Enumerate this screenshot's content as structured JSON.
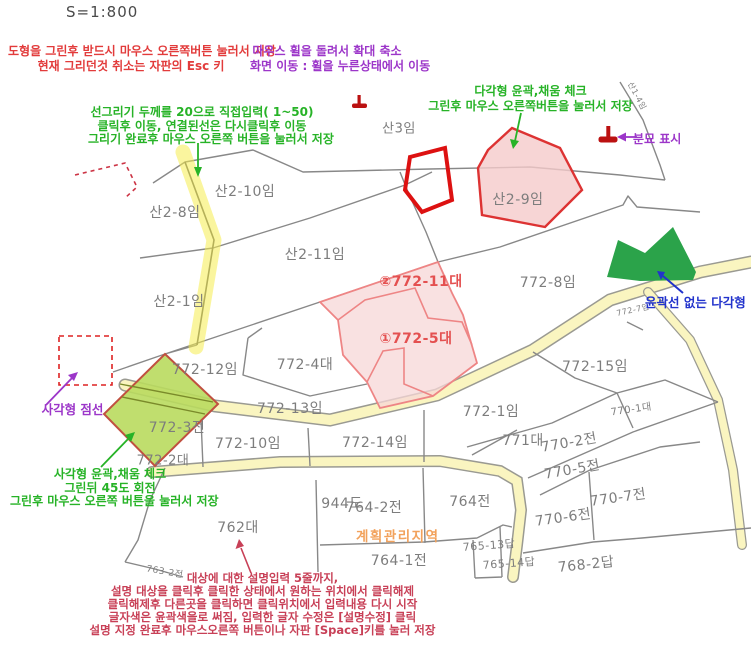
{
  "colors": {
    "red_instruction": "#e23b3b",
    "purple_instruction": "#9c36c9",
    "green_instruction": "#27b327",
    "blue_label": "#2233cc",
    "crimson_description": "#c84057",
    "zone_orange": "#f2a25c",
    "parcel_gray": "#7d7d7d",
    "parcel_red": "#e45050",
    "road_yellow": "#faf5c0",
    "road_edge": "#9a9a92",
    "highlight_yellow": "#f5ec4e",
    "pink_fill": "#f7d7d7",
    "pink_stroke": "#ee8585",
    "red_shape": "#dd1111",
    "pentagon_fill": "#f5caca",
    "pentagon_stroke": "#dd3333",
    "green_fill": "#2ba34a",
    "diamond_fill": "#b9da5e",
    "diamond_stroke": "#c05040",
    "boundary_gray": "#888888",
    "grave_red": "#bb1111"
  },
  "scale_label": "S=1:800",
  "annotations": {
    "draw_save_red": {
      "line1": "도형을 그린후 받드시 마우스 오른쪽버튼 눌러서 저장",
      "line2": "현재 그리던것 취소는 자판의 Esc 키"
    },
    "mouse_wheel_purple": {
      "line1": "마우스 휠을 돌려서 확대 축소",
      "line2": "화면 이동 : 휠을 누른상태에서 이동"
    },
    "line_draw_green": {
      "line1": "선그리기 두께를 20으로 직접입력( 1~50)",
      "line2": "클릭후 이동, 연결된선은 다시클릭후 이동",
      "line3": "그리기 완료후 마우스 오른쪽 버튼을 눌러서 저장"
    },
    "polygon_green": {
      "line1": "다각형 윤곽,채움 체크",
      "line2": "그린후 마우스 오른쪽버튼을 눌러서 저장"
    },
    "grave_purple": {
      "label": "분묘 표시"
    },
    "dashed_purple": {
      "label": "사각형 점선"
    },
    "rect_green": {
      "line1": "사각형 윤곽,채움 체크",
      "line2": "그린뒤 45도 회전",
      "line3": "그린후 마우스 오른쪽 버튼을 눌러서 저장"
    },
    "no_outline_blue": {
      "label": "윤곽선 없는 다각형"
    },
    "zone_orange": {
      "label": "계획관리지역"
    },
    "description_crimson": {
      "line1": "대상에 대한 설명입력 5줄까지,",
      "line2": "설명 대상을 클릭후 클릭한 상태에서 원하는 위치에서 클릭해제",
      "line3": "클릭해제후 다른곳을 클릭하면 클릭위치에서 입력내용 다시 시작",
      "line4": "글자색은 윤곽색을로 써짐, 입력한 글자 수정은 [설명수정] 클릭",
      "line5": "설명 지정 완료후 마우스오른쪽 버튼이나 자판 [Space]키를 눌러 저장"
    }
  },
  "map": {
    "parcels": [
      {
        "t": "산3임",
        "x": 399,
        "y": 127,
        "fs": 13
      },
      {
        "t": "산2-10임",
        "x": 245,
        "y": 191,
        "fs": 14
      },
      {
        "t": "산2-8임",
        "x": 175,
        "y": 212,
        "fs": 14
      },
      {
        "t": "산2-11임",
        "x": 315,
        "y": 254,
        "fs": 14
      },
      {
        "t": "산2-1임",
        "x": 179,
        "y": 301,
        "fs": 14
      },
      {
        "t": "산2-9임",
        "x": 518,
        "y": 199,
        "fs": 14
      },
      {
        "t": "산1-4임",
        "x": 637,
        "y": 96,
        "fs": 8,
        "rot": 62
      },
      {
        "t": "772-8임",
        "x": 548,
        "y": 282,
        "fs": 14
      },
      {
        "t": "772-7임",
        "x": 633,
        "y": 310,
        "fs": 8,
        "rot": -12
      },
      {
        "t": "②772-11대",
        "x": 421,
        "y": 281,
        "fs": 14,
        "c": "red"
      },
      {
        "t": "①772-5대",
        "x": 416,
        "y": 338,
        "fs": 14,
        "c": "red"
      },
      {
        "t": "772-4대",
        "x": 305,
        "y": 364,
        "fs": 14
      },
      {
        "t": "772-12임",
        "x": 205,
        "y": 369,
        "fs": 14
      },
      {
        "t": "772-13임",
        "x": 290,
        "y": 408,
        "fs": 14
      },
      {
        "t": "772-3전",
        "x": 177,
        "y": 427,
        "fs": 14
      },
      {
        "t": "772-2대",
        "x": 163,
        "y": 459,
        "fs": 13
      },
      {
        "t": "772-10임",
        "x": 248,
        "y": 443,
        "fs": 14
      },
      {
        "t": "772-14임",
        "x": 375,
        "y": 442,
        "fs": 14
      },
      {
        "t": "772-1임",
        "x": 491,
        "y": 411,
        "fs": 14
      },
      {
        "t": "772-15임",
        "x": 595,
        "y": 366,
        "fs": 14
      },
      {
        "t": "771대",
        "x": 523,
        "y": 440,
        "fs": 14
      },
      {
        "t": "770-1대",
        "x": 631,
        "y": 408,
        "fs": 10,
        "rot": -8
      },
      {
        "t": "770-2전",
        "x": 569,
        "y": 442,
        "fs": 14,
        "rot": -10
      },
      {
        "t": "770-5전",
        "x": 572,
        "y": 469,
        "fs": 14,
        "rot": -10
      },
      {
        "t": "770-7전",
        "x": 618,
        "y": 497,
        "fs": 14,
        "rot": -8
      },
      {
        "t": "770-6전",
        "x": 563,
        "y": 517,
        "fs": 14,
        "rot": -8
      },
      {
        "t": "768-2답",
        "x": 586,
        "y": 564,
        "fs": 14,
        "rot": -6
      },
      {
        "t": "765-13답",
        "x": 489,
        "y": 545,
        "fs": 11,
        "rot": -4
      },
      {
        "t": "765-14답",
        "x": 509,
        "y": 563,
        "fs": 11,
        "rot": -4
      },
      {
        "t": "764전",
        "x": 470,
        "y": 501,
        "fs": 14
      },
      {
        "t": "944도",
        "x": 342,
        "y": 503,
        "fs": 14
      },
      {
        "t": "764-2전",
        "x": 374,
        "y": 507,
        "fs": 14
      },
      {
        "t": "764-1전",
        "x": 399,
        "y": 560,
        "fs": 14
      },
      {
        "t": "762대",
        "x": 238,
        "y": 527,
        "fs": 14
      },
      {
        "t": "763-2전",
        "x": 165,
        "y": 571,
        "fs": 9,
        "rot": 10
      }
    ]
  }
}
